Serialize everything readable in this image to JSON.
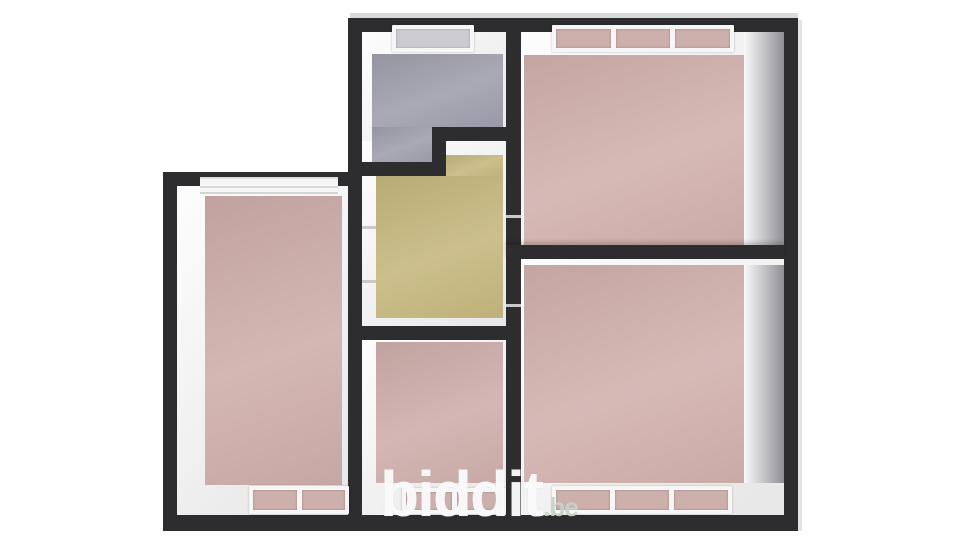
{
  "watermark": {
    "brand": "biddit",
    "tld": ".be"
  },
  "palette": {
    "background": "#ffffff",
    "wall": "#2d2c2e",
    "outer_highlight": "#d8d8d8",
    "inner_face_light": "#f2f1f2",
    "inner_face_shadow": "#aeadb3",
    "window_frame": "#f6f6f6",
    "window_pane_pink": "#cdafac",
    "window_pane_gray": "#cbcbd1",
    "door_jamb_mark": "#c9c9c9"
  },
  "rooms": {
    "left": {
      "floor_color": "#cfaeab"
    },
    "top_center": {
      "floor_color": "#a09fad"
    },
    "top_right": {
      "floor_color": "#d2b1ae"
    },
    "middle": {
      "floor_color": "#c6b87e"
    },
    "bottom_middle": {
      "floor_color": "#cfafac"
    },
    "bottom_right": {
      "floor_color": "#d2b1ae"
    }
  }
}
